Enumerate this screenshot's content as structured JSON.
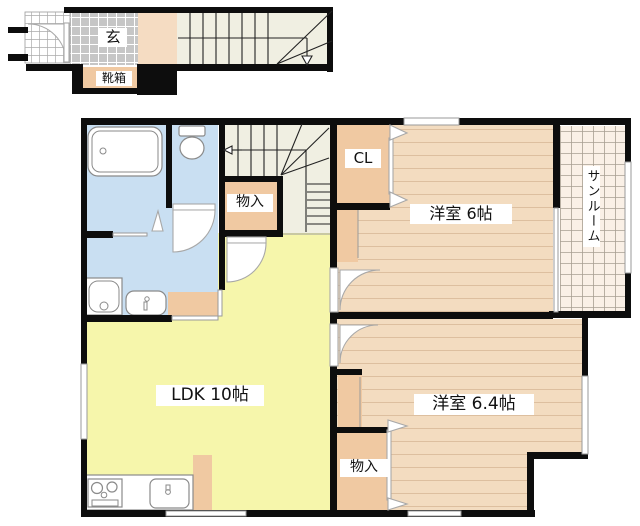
{
  "plan": {
    "labels": {
      "entrance": "玄",
      "shoe_box": "靴箱",
      "storage_under_stairs": "物入",
      "closet": "CL",
      "bedroom1": "洋室 6帖",
      "sunroom": "サンルーム",
      "ldk": "LDK 10帖",
      "bedroom2": "洋室 6.4帖",
      "storage2": "物入"
    },
    "palette": {
      "wall": "#0d0d0d",
      "water_blue": "#c9dff2",
      "ldk_yellow": "#f6f6ab",
      "room_beige": "#f3dcc0",
      "closet_peach": "#f0c9a2",
      "hall_beige": "#f5dcc2",
      "sunroom_cream": "#faf0e6",
      "stair_cream": "#f0efe2",
      "tile_gray": "#c6c6c6",
      "white": "#ffffff"
    }
  }
}
